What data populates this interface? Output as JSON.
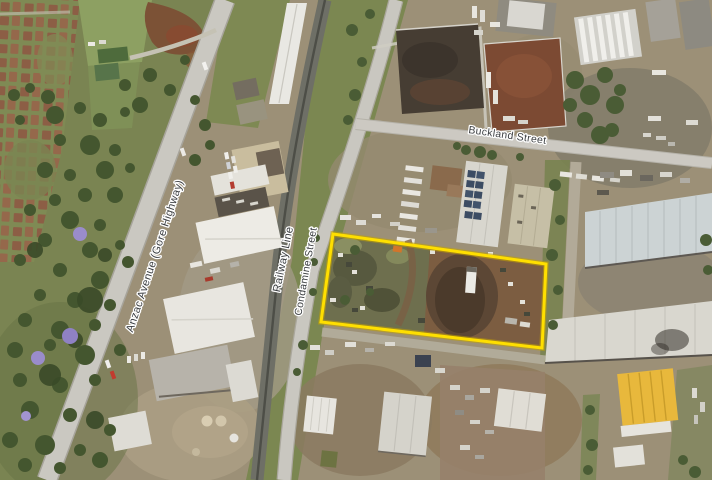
{
  "map": {
    "type": "aerial-photo",
    "labels": {
      "anzac": "Anzac Avenue (Gore Highway)",
      "railway": "Railway Line",
      "condamine": "Condamine Street",
      "buckland": "Buckland Street"
    },
    "label_style": {
      "text_color": "#3a3d40",
      "halo_color": "#ffffff"
    },
    "boundary": {
      "color": "#ffdf00",
      "outline_color": "#c2a300",
      "points": "333,234 546,264 542,348 321,322"
    }
  }
}
